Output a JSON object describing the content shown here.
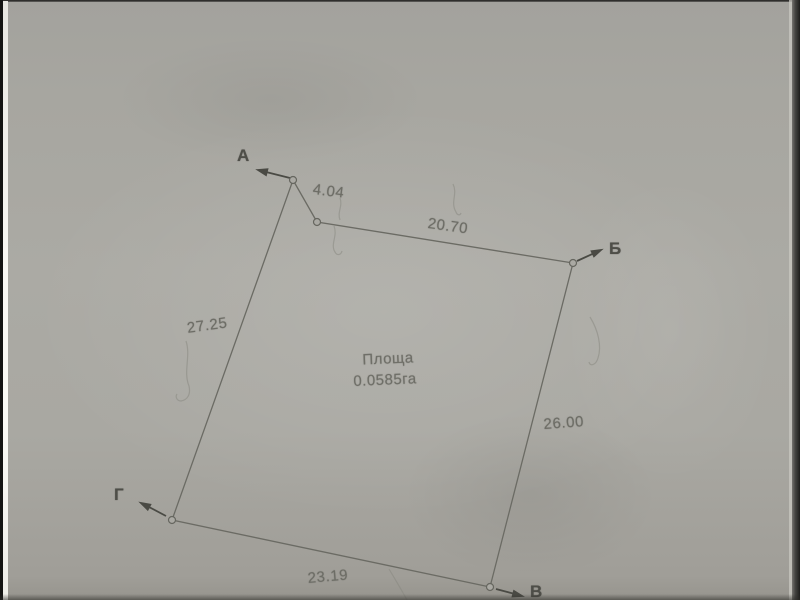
{
  "palette": {
    "paper": "#a8a7a1",
    "ink_line": "#6b6b64",
    "dimension_text": "#6d6d66",
    "vertex_text": "#4e4e48"
  },
  "parcel": {
    "area_label": "Площа",
    "area_value": "0.0585га",
    "vertices": {
      "a": "А",
      "b": "Б",
      "v": "В",
      "g": "Г"
    },
    "dimensions": {
      "segment_a": "4.04",
      "top": "20.70",
      "left": "27.25",
      "right": "26.00",
      "bottom": "23.19"
    }
  }
}
